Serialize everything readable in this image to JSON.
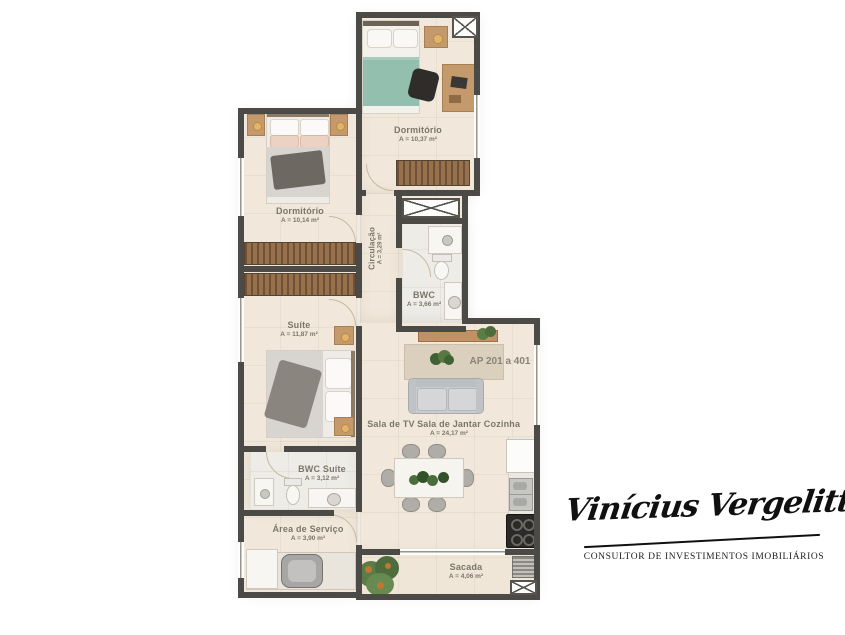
{
  "plan": {
    "unit_label": "AP 201 a 401",
    "rooms": {
      "dorm_top": {
        "name": "Dormitório",
        "area": "A = 10,37 m²"
      },
      "dorm_left": {
        "name": "Dormitório",
        "area": "A = 10,14 m²"
      },
      "circulacao": {
        "name": "Circulação",
        "area": "A = 3,29 m²"
      },
      "bwc": {
        "name": "BWC",
        "area": "A = 3,66 m²"
      },
      "suite": {
        "name": "Suíte",
        "area": "A = 11,87 m²"
      },
      "sala_tv": {
        "name": "Sala de TV"
      },
      "sala_jantar": {
        "name": "Sala de Jantar",
        "area": "A = 24,17 m²"
      },
      "cozinha": {
        "name": "Cozinha"
      },
      "bwc_suite": {
        "name": "BWC Suíte",
        "area": "A = 3,12 m²"
      },
      "area_servico": {
        "name": "Área de Serviço",
        "area": "A = 3,90 m²"
      },
      "sacada": {
        "name": "Sacada",
        "area": "A = 4,06 m²"
      }
    }
  },
  "branding": {
    "signature": "Vinícius Vergelitti",
    "tagline": "CONSULTOR DE INVESTIMENTOS IMOBILIÁRIOS"
  },
  "colors": {
    "wall": "#4b4a46",
    "floor": "#f1e8db",
    "wood": "#c49a6d",
    "teal_bedding": "#93bfae",
    "label_text": "#7b766b"
  }
}
